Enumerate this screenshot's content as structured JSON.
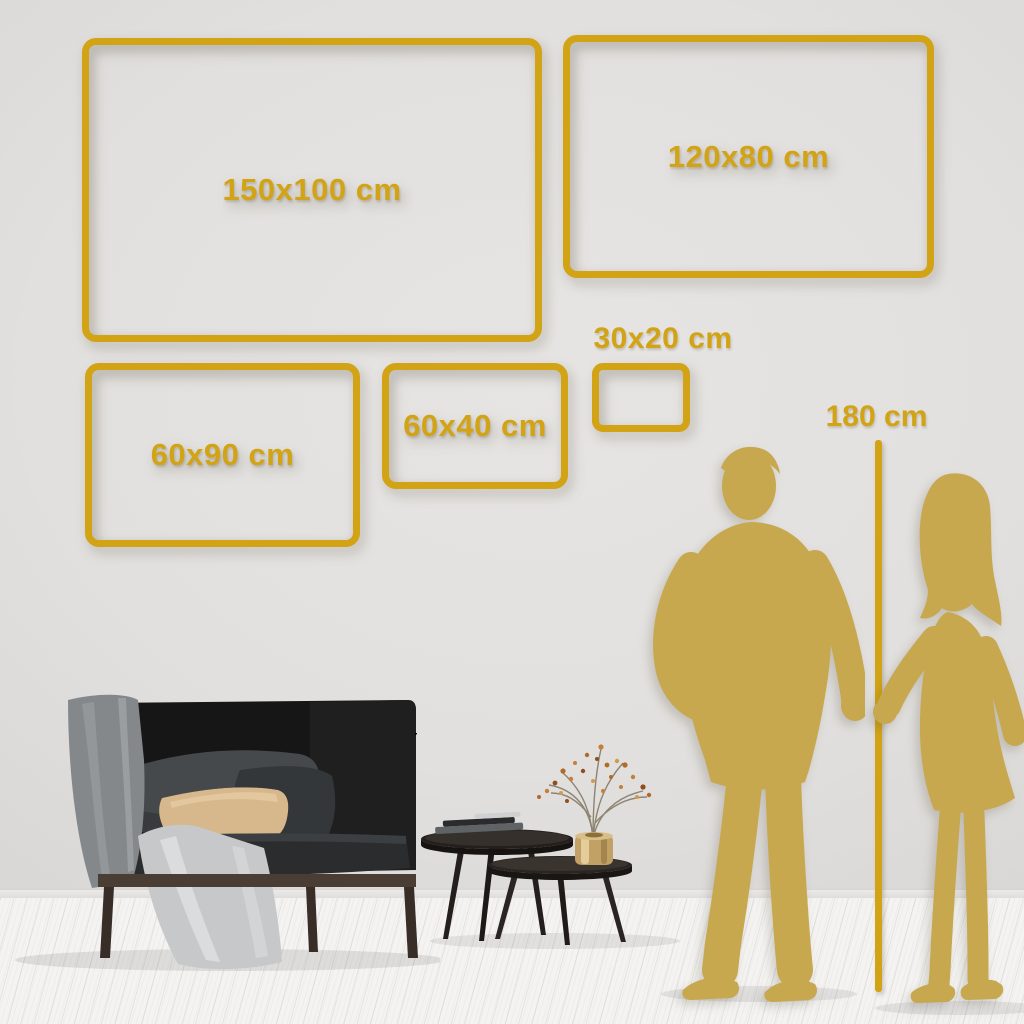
{
  "colors": {
    "gold": "#d2a315",
    "silhouette": "#c7a84f",
    "wall-center": "#e7e5e3",
    "wall-edge": "#d8d6d4",
    "floor": "#f4f3f1"
  },
  "size_frames": {
    "items": [
      {
        "label": "150x100 cm",
        "width_cm": 150,
        "height_cm": 100
      },
      {
        "label": "120x80 cm",
        "width_cm": 120,
        "height_cm": 80
      },
      {
        "label": "60x90 cm",
        "width_cm": 90,
        "height_cm": 60
      },
      {
        "label": "60x40 cm",
        "width_cm": 60,
        "height_cm": 40
      },
      {
        "label": "30x20 cm",
        "width_cm": 30,
        "height_cm": 20
      }
    ]
  },
  "height_marker": {
    "label": "180 cm",
    "value_cm": 180
  },
  "illustration": {
    "objects": [
      "man-silhouette",
      "woman-silhouette",
      "sofa",
      "throw-blanket",
      "draped-cloth",
      "beige-pillow",
      "gray-cushion",
      "nesting-coffee-tables",
      "books",
      "brass-vase",
      "dried-branch"
    ]
  }
}
